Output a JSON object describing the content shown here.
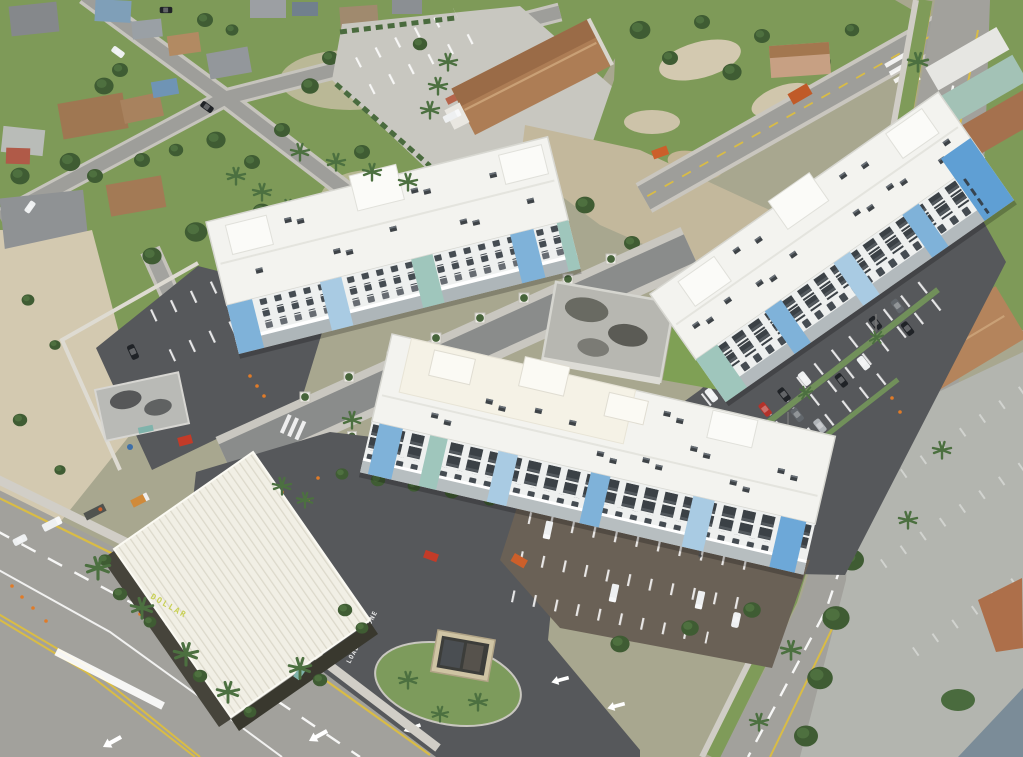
{
  "markings": {
    "loading_zone": "LOADING ZONE",
    "store_sign": "DOLLAR"
  },
  "palette": {
    "base": "#a8a78f",
    "grass": "#7e9a58",
    "grass_dark": "#5f8243",
    "tree": "#3f5c33",
    "sand": "#d3c9b0",
    "dirt": "#c3b89c",
    "road": "#9e9e9a",
    "road_major": "#a2a19c",
    "asphalt_new": "#56585b",
    "lot_brown": "#6a6156",
    "lot_old": "#b3b5af",
    "concrete": "#c8c7c0",
    "sidewalk": "#d0cdc6",
    "roof_white": "#f3f3ef",
    "roof_cream": "#f5f2e6",
    "facade_white": "#eef0ef",
    "facade_blue": "#7fb2d9",
    "facade_blue_light": "#a9cbe3",
    "facade_blue_bright": "#5f9fd4",
    "facade_teal": "#9fc6bc",
    "window_dark": "#333a41",
    "roof_church": "#ad7d55",
    "store_roof": "#f1efe5",
    "store_wall": "#46443b",
    "store_sign_color": "#c8d054",
    "line_white": "#ffffff",
    "line_yellow": "#d9bc45",
    "cone_orange": "#e07b28",
    "machine_orange": "#cc5f2a"
  }
}
